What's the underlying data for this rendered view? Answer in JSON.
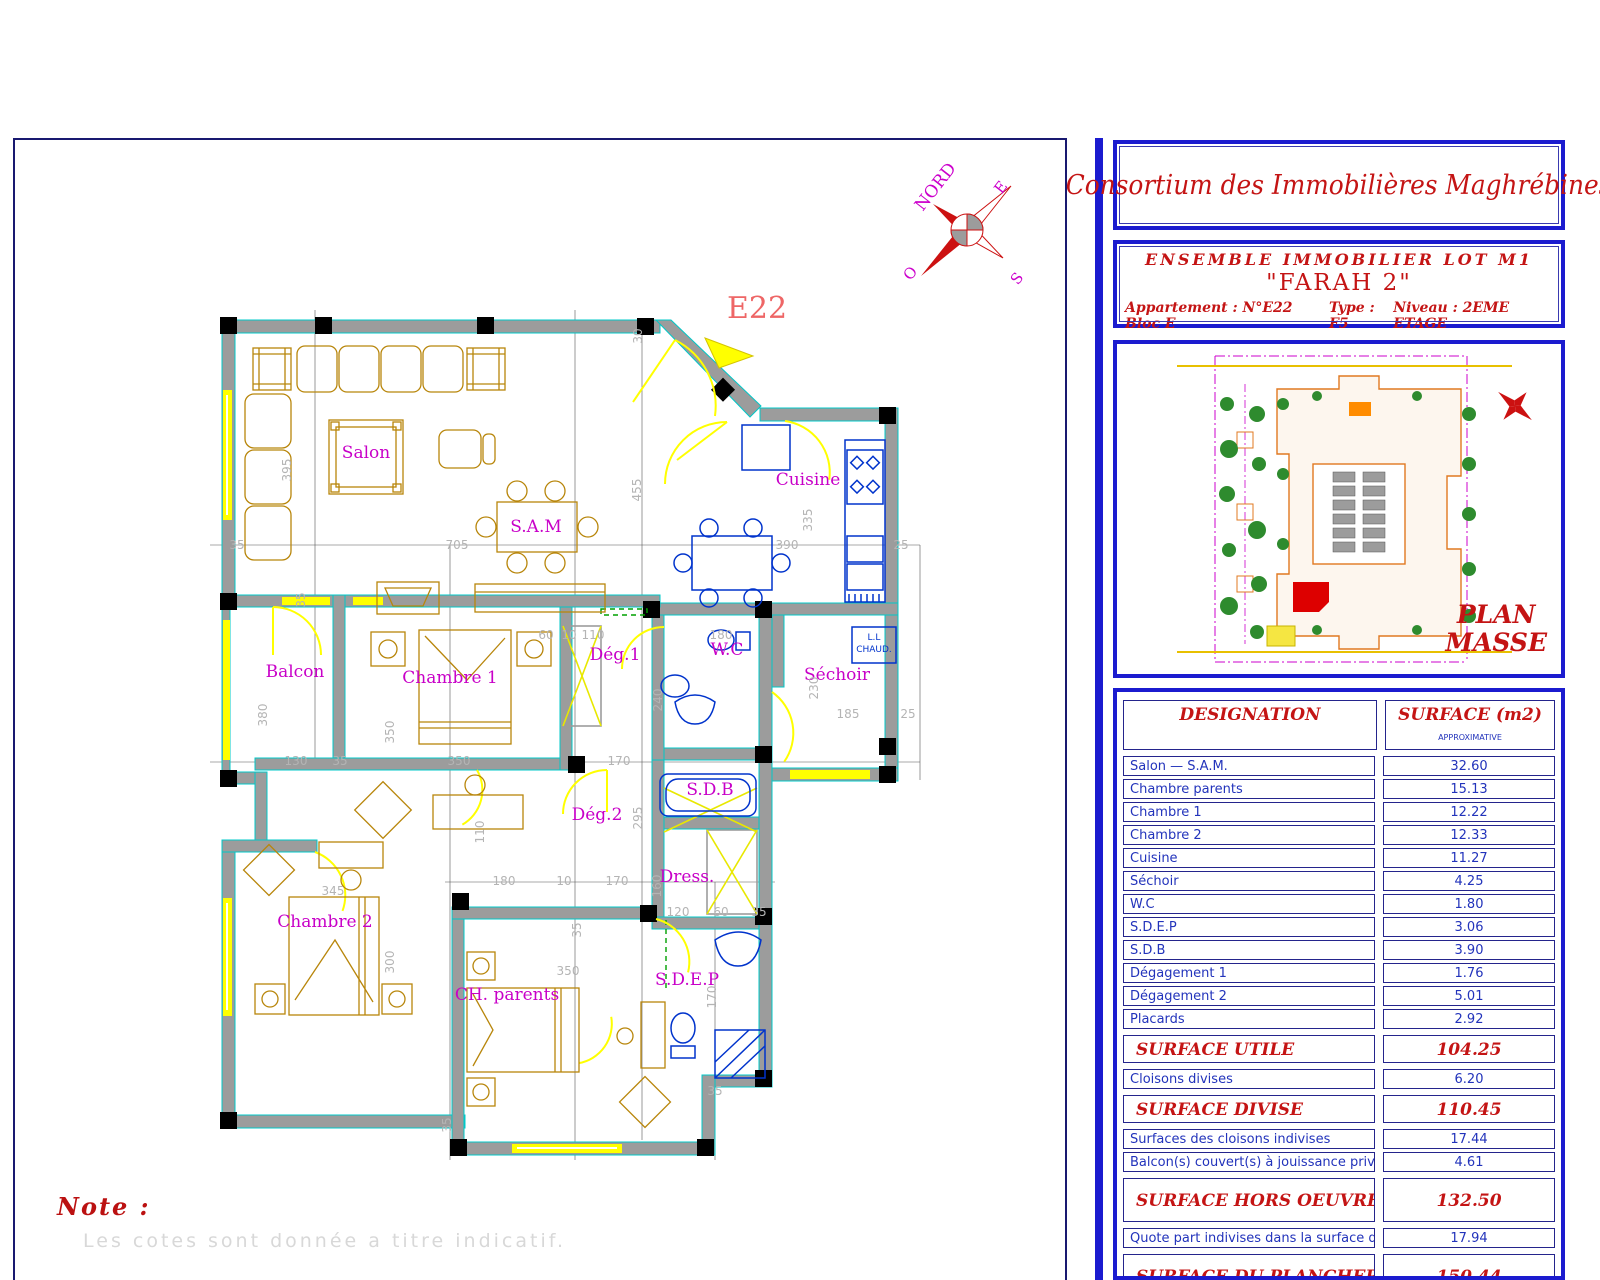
{
  "sheet": {
    "note_title": "Note :",
    "note_text": "Les cotes sont donnée a titre indicatif.",
    "floor_plan": {
      "unit_label": "E22",
      "compass": {
        "n": "NORD",
        "e": "E",
        "s": "S",
        "o": "O"
      },
      "heater": {
        "l1": "L.L",
        "l2": "CHAUD."
      },
      "room_labels": [
        {
          "t": "Salon",
          "x": 351,
          "y": 318
        },
        {
          "t": "S.A.M",
          "x": 521,
          "y": 392
        },
        {
          "t": "Cuisine",
          "x": 793,
          "y": 345
        },
        {
          "t": "Balcon",
          "x": 280,
          "y": 537
        },
        {
          "t": "Chambre 1",
          "x": 435,
          "y": 543
        },
        {
          "t": "Dég.1",
          "x": 600,
          "y": 520
        },
        {
          "t": "W.C",
          "x": 712,
          "y": 515
        },
        {
          "t": "Séchoir",
          "x": 822,
          "y": 540
        },
        {
          "t": "S.D.B",
          "x": 695,
          "y": 655
        },
        {
          "t": "Dég.2",
          "x": 582,
          "y": 680
        },
        {
          "t": "Dress.",
          "x": 672,
          "y": 742
        },
        {
          "t": "Chambre 2",
          "x": 310,
          "y": 787
        },
        {
          "t": "CH. parents",
          "x": 492,
          "y": 860
        },
        {
          "t": "S.D.E.P",
          "x": 672,
          "y": 845
        }
      ],
      "dim_labels": [
        {
          "t": "30",
          "x": 627,
          "y": 196,
          "r": 1
        },
        {
          "t": "455",
          "x": 626,
          "y": 350,
          "r": 1
        },
        {
          "t": "395",
          "x": 276,
          "y": 330,
          "r": 1
        },
        {
          "t": "35",
          "x": 222,
          "y": 409
        },
        {
          "t": "705",
          "x": 442,
          "y": 409
        },
        {
          "t": "390",
          "x": 772,
          "y": 409
        },
        {
          "t": "25",
          "x": 886,
          "y": 409
        },
        {
          "t": "335",
          "x": 797,
          "y": 380,
          "r": 1
        },
        {
          "t": "35",
          "x": 290,
          "y": 460,
          "r": 1
        },
        {
          "t": "380",
          "x": 252,
          "y": 575,
          "r": 1
        },
        {
          "t": "350",
          "x": 379,
          "y": 592,
          "r": 1
        },
        {
          "t": "60",
          "x": 531,
          "y": 499
        },
        {
          "t": "10",
          "x": 554,
          "y": 499
        },
        {
          "t": "110",
          "x": 578,
          "y": 499
        },
        {
          "t": "180",
          "x": 706,
          "y": 499
        },
        {
          "t": "230",
          "x": 803,
          "y": 548,
          "r": 1
        },
        {
          "t": "185",
          "x": 833,
          "y": 578
        },
        {
          "t": "25",
          "x": 893,
          "y": 578
        },
        {
          "t": "130",
          "x": 281,
          "y": 625
        },
        {
          "t": "35",
          "x": 325,
          "y": 625
        },
        {
          "t": "350",
          "x": 444,
          "y": 625
        },
        {
          "t": "170",
          "x": 604,
          "y": 625
        },
        {
          "t": "240",
          "x": 647,
          "y": 560,
          "r": 1
        },
        {
          "t": "295",
          "x": 627,
          "y": 678,
          "r": 1
        },
        {
          "t": "110",
          "x": 469,
          "y": 692,
          "r": 1
        },
        {
          "t": "180",
          "x": 489,
          "y": 745
        },
        {
          "t": "10",
          "x": 549,
          "y": 745
        },
        {
          "t": "170",
          "x": 602,
          "y": 745
        },
        {
          "t": "345",
          "x": 318,
          "y": 755
        },
        {
          "t": "300",
          "x": 379,
          "y": 822,
          "r": 1
        },
        {
          "t": "160",
          "x": 646,
          "y": 746,
          "r": 1
        },
        {
          "t": "120",
          "x": 663,
          "y": 776
        },
        {
          "t": "60",
          "x": 706,
          "y": 776
        },
        {
          "t": "35",
          "x": 744,
          "y": 776
        },
        {
          "t": "350",
          "x": 553,
          "y": 835
        },
        {
          "t": "170",
          "x": 701,
          "y": 857,
          "r": 1
        },
        {
          "t": "35",
          "x": 566,
          "y": 790,
          "r": 1
        },
        {
          "t": "35",
          "x": 700,
          "y": 955
        },
        {
          "t": "35",
          "x": 436,
          "y": 985,
          "r": 1
        }
      ]
    }
  },
  "panel": {
    "company": "Consortium des Immobilières Maghrébines",
    "project": {
      "line1": "ENSEMBLE   IMMOBILIER  LOT  M1",
      "line2": "\"FARAH 2\"",
      "apt": "Appartement : N°E22 Bloc E",
      "type": "Type : F5",
      "niveau": "Niveau : 2EME ETAGE"
    },
    "plan_masse": {
      "title1": "PLAN",
      "title2": "MASSE"
    },
    "table": {
      "header": {
        "designation": "DESIGNATION",
        "surface": "SURFACE  (m2)",
        "approx": "APPROXIMATIVE"
      },
      "rows": [
        {
          "type": "n",
          "label": "Salon — S.A.M.",
          "value": "32.60"
        },
        {
          "type": "n",
          "label": "Chambre parents",
          "value": "15.13"
        },
        {
          "type": "n",
          "label": "Chambre 1",
          "value": "12.22"
        },
        {
          "type": "n",
          "label": "Chambre 2",
          "value": "12.33"
        },
        {
          "type": "n",
          "label": "Cuisine",
          "value": "11.27"
        },
        {
          "type": "n",
          "label": "Séchoir",
          "value": "4.25"
        },
        {
          "type": "n",
          "label": "W.C",
          "value": "1.80"
        },
        {
          "type": "n",
          "label": "S.D.E.P",
          "value": "3.06"
        },
        {
          "type": "n",
          "label": "S.D.B",
          "value": "3.90"
        },
        {
          "type": "n",
          "label": "Dégagement 1",
          "value": "1.76"
        },
        {
          "type": "n",
          "label": "Dégagement 2",
          "value": "5.01"
        },
        {
          "type": "n",
          "label": "Placards",
          "value": "2.92"
        },
        {
          "type": "s",
          "label": "SURFACE  UTILE",
          "value": "104.25"
        },
        {
          "type": "n",
          "label": "Cloisons divises",
          "value": "6.20"
        },
        {
          "type": "s",
          "label": "SURFACE  DIVISE",
          "value": "110.45"
        },
        {
          "type": "n",
          "label": "Surfaces des cloisons indivises",
          "value": "17.44"
        },
        {
          "type": "n",
          "label": "Balcon(s) couvert(s) à jouissance privative",
          "value": "4.61"
        },
        {
          "type": "st",
          "label": "SURFACE  HORS  OEUVRE",
          "value": "132.50"
        },
        {
          "type": "n",
          "label": "Quote part indivises dans la surface du plancher",
          "value": "17.94"
        },
        {
          "type": "st",
          "label": "SURFACE  DU  PLANCHER",
          "value": "150.44"
        },
        {
          "type": "p",
          "label": "Numéro de la place de parking",
          "value": "--"
        }
      ]
    }
  }
}
